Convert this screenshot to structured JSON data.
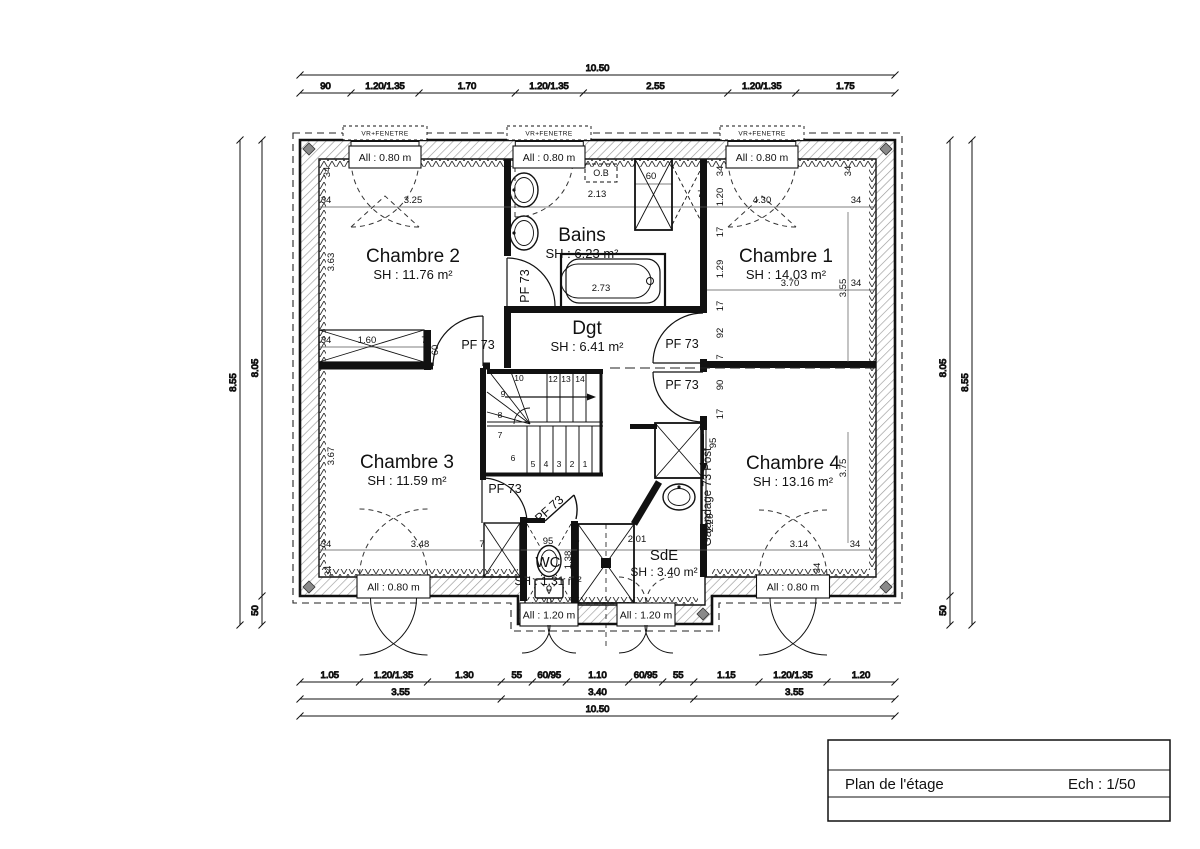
{
  "title_block": {
    "title": "Plan de l'étage",
    "scale": "Ech : 1/50"
  },
  "plan": {
    "window_header": "VR+FENETRE",
    "labels": {
      "pf": "PF 73",
      "galandage": "Galandage 73 Post",
      "ob": "O.B"
    },
    "rooms": [
      {
        "id": "chambre2",
        "name": "Chambre 2",
        "area": "SH : 11.76 m²"
      },
      {
        "id": "bains",
        "name": "Bains",
        "area": "SH : 6.23 m²"
      },
      {
        "id": "chambre1",
        "name": "Chambre 1",
        "area": "SH : 14.03 m²"
      },
      {
        "id": "dgt",
        "name": "Dgt",
        "area": "SH : 6.41 m²"
      },
      {
        "id": "chambre3",
        "name": "Chambre 3",
        "area": "SH : 11.59 m²"
      },
      {
        "id": "wc",
        "name": "WC",
        "area": "SH : 1.31 m²"
      },
      {
        "id": "sde",
        "name": "SdE",
        "area": "SH : 3.40 m²"
      },
      {
        "id": "chambre4",
        "name": "Chambre 4",
        "area": "SH : 13.16 m²"
      }
    ],
    "windows": [
      {
        "id": "top-left",
        "label": "All : 0.80 m"
      },
      {
        "id": "top-middle",
        "label": "All : 0.80 m"
      },
      {
        "id": "top-right",
        "label": "All : 0.80 m"
      },
      {
        "id": "bottom-left",
        "label": "All : 0.80 m"
      },
      {
        "id": "bottom-right",
        "label": "All : 0.80 m"
      },
      {
        "id": "bay-left",
        "label": "All : 1.20 m"
      },
      {
        "id": "bay-right",
        "label": "All : 1.20 m"
      }
    ],
    "dim_rows": [
      {
        "o": "h",
        "y": 75,
        "ticks": [
          300,
          895
        ],
        "labels": [
          {
            "t": "10.50",
            "x": 597.5
          }
        ]
      },
      {
        "o": "h",
        "y": 93,
        "ticks": [
          300,
          351,
          419,
          515.3,
          583.3,
          727.8,
          795.8,
          895
        ],
        "labels": [
          {
            "t": "90",
            "x": 325.5
          },
          {
            "t": "1.20/1.35",
            "x": 385
          },
          {
            "t": "1.70",
            "x": 467
          },
          {
            "t": "1.20/1.35",
            "x": 549
          },
          {
            "t": "2.55",
            "x": 655.5
          },
          {
            "t": "1.20/1.35",
            "x": 761.8
          },
          {
            "t": "1.75",
            "x": 845.4
          }
        ]
      },
      {
        "o": "h",
        "y": 682,
        "ticks": [
          300,
          359.5,
          427.5,
          501.2,
          532.3,
          566.3,
          628.7,
          662.7,
          693.8,
          759,
          827,
          895
        ],
        "labels": [
          {
            "t": "1.05",
            "x": 329.8
          },
          {
            "t": "1.20/1.35",
            "x": 393.5
          },
          {
            "t": "1.30",
            "x": 464.4
          },
          {
            "t": "55",
            "x": 516.8
          },
          {
            "t": "60/95",
            "x": 549.3
          },
          {
            "t": "1.10",
            "x": 597.5
          },
          {
            "t": "60/95",
            "x": 645.7
          },
          {
            "t": "55",
            "x": 678.3
          },
          {
            "t": "1.15",
            "x": 726.4
          },
          {
            "t": "1.20/1.35",
            "x": 793
          },
          {
            "t": "1.20",
            "x": 861
          }
        ]
      },
      {
        "o": "h",
        "y": 699,
        "ticks": [
          300,
          501.2,
          693.8,
          895
        ],
        "labels": [
          {
            "t": "3.55",
            "x": 400.6
          },
          {
            "t": "3.40",
            "x": 597.5
          },
          {
            "t": "3.55",
            "x": 794.4
          }
        ]
      },
      {
        "o": "h",
        "y": 716,
        "ticks": [
          300,
          895
        ],
        "labels": [
          {
            "t": "10.50",
            "x": 597.5
          }
        ]
      },
      {
        "o": "v",
        "x": 240,
        "ticks": [
          140,
          625
        ],
        "labels": [
          {
            "t": "8.55",
            "y": 382.5
          }
        ]
      },
      {
        "o": "v",
        "x": 262,
        "ticks": [
          140,
          596,
          625
        ],
        "labels": [
          {
            "t": "8.05",
            "y": 368
          },
          {
            "t": "50",
            "y": 610.5
          }
        ]
      },
      {
        "o": "v",
        "x": 950,
        "ticks": [
          140,
          596,
          625
        ],
        "labels": [
          {
            "t": "8.05",
            "y": 368
          },
          {
            "t": "50",
            "y": 610.5
          }
        ]
      },
      {
        "o": "v",
        "x": 972,
        "ticks": [
          140,
          625
        ],
        "labels": [
          {
            "t": "8.55",
            "y": 382.5
          }
        ]
      }
    ],
    "annotations": [
      {
        "t": "34",
        "x": 326,
        "y": 203
      },
      {
        "t": "3.25",
        "x": 413,
        "y": 203
      },
      {
        "t": "7",
        "x": 510,
        "y": 203
      },
      {
        "t": "2.13",
        "x": 597,
        "y": 197
      },
      {
        "t": "7",
        "x": 700,
        "y": 197
      },
      {
        "t": "4.30",
        "x": 762,
        "y": 203
      },
      {
        "t": "34",
        "x": 856,
        "y": 203
      },
      {
        "t": "34",
        "x": 330,
        "y": 172,
        "r": -90
      },
      {
        "t": "34",
        "x": 723,
        "y": 171,
        "r": -90
      },
      {
        "t": "34",
        "x": 851,
        "y": 171,
        "r": -90
      },
      {
        "t": "1.20",
        "x": 723,
        "y": 197,
        "r": -90
      },
      {
        "t": "17",
        "x": 723,
        "y": 232,
        "r": -90
      },
      {
        "t": "1.29",
        "x": 723,
        "y": 269,
        "r": -90
      },
      {
        "t": "17",
        "x": 723,
        "y": 306,
        "r": -90
      },
      {
        "t": "92",
        "x": 723,
        "y": 333,
        "r": -90
      },
      {
        "t": "7",
        "x": 723,
        "y": 357,
        "r": -90
      },
      {
        "t": "90",
        "x": 723,
        "y": 385,
        "r": -90
      },
      {
        "t": "17",
        "x": 723,
        "y": 414,
        "r": -90
      },
      {
        "t": "95",
        "x": 716,
        "y": 443,
        "r": -90
      },
      {
        "t": "2.26",
        "x": 713,
        "y": 523,
        "r": -90
      },
      {
        "t": "3.63",
        "x": 334,
        "y": 262,
        "r": -90
      },
      {
        "t": "3.55",
        "x": 846,
        "y": 288,
        "r": -90
      },
      {
        "t": "3.70",
        "x": 790,
        "y": 286
      },
      {
        "t": "34",
        "x": 856,
        "y": 286
      },
      {
        "t": "2.73",
        "x": 601,
        "y": 291
      },
      {
        "t": "60",
        "x": 651,
        "y": 179
      },
      {
        "t": "34",
        "x": 326,
        "y": 343
      },
      {
        "t": "1.60",
        "x": 367,
        "y": 343
      },
      {
        "t": "7",
        "x": 424,
        "y": 343
      },
      {
        "t": "60",
        "x": 438,
        "y": 350,
        "r": -90
      },
      {
        "t": "3.67",
        "x": 334,
        "y": 456,
        "r": -90
      },
      {
        "t": "34",
        "x": 326,
        "y": 547
      },
      {
        "t": "3.48",
        "x": 420,
        "y": 547
      },
      {
        "t": "34",
        "x": 331,
        "y": 571,
        "r": -90
      },
      {
        "t": "7",
        "x": 482,
        "y": 547
      },
      {
        "t": "95",
        "x": 548,
        "y": 544
      },
      {
        "t": "7",
        "x": 577,
        "y": 547
      },
      {
        "t": "2.01",
        "x": 637,
        "y": 542
      },
      {
        "t": "1.38",
        "x": 571,
        "y": 560,
        "r": -90
      },
      {
        "t": "3.14",
        "x": 799,
        "y": 547
      },
      {
        "t": "34",
        "x": 855,
        "y": 547
      },
      {
        "t": "34",
        "x": 820,
        "y": 568,
        "r": -90
      },
      {
        "t": "3.75",
        "x": 846,
        "y": 468,
        "r": -90
      }
    ],
    "stair_numbers": [
      {
        "t": "1",
        "x": 585,
        "y": 467
      },
      {
        "t": "2",
        "x": 572,
        "y": 467
      },
      {
        "t": "3",
        "x": 559,
        "y": 467
      },
      {
        "t": "4",
        "x": 546,
        "y": 467
      },
      {
        "t": "5",
        "x": 533,
        "y": 467
      },
      {
        "t": "6",
        "x": 513,
        "y": 461
      },
      {
        "t": "7",
        "x": 500,
        "y": 438
      },
      {
        "t": "8",
        "x": 500,
        "y": 418
      },
      {
        "t": "9",
        "x": 503,
        "y": 397
      },
      {
        "t": "10",
        "x": 519,
        "y": 381
      },
      {
        "t": "12",
        "x": 553,
        "y": 382
      },
      {
        "t": "13",
        "x": 566,
        "y": 382
      },
      {
        "t": "14",
        "x": 580,
        "y": 382
      }
    ]
  }
}
